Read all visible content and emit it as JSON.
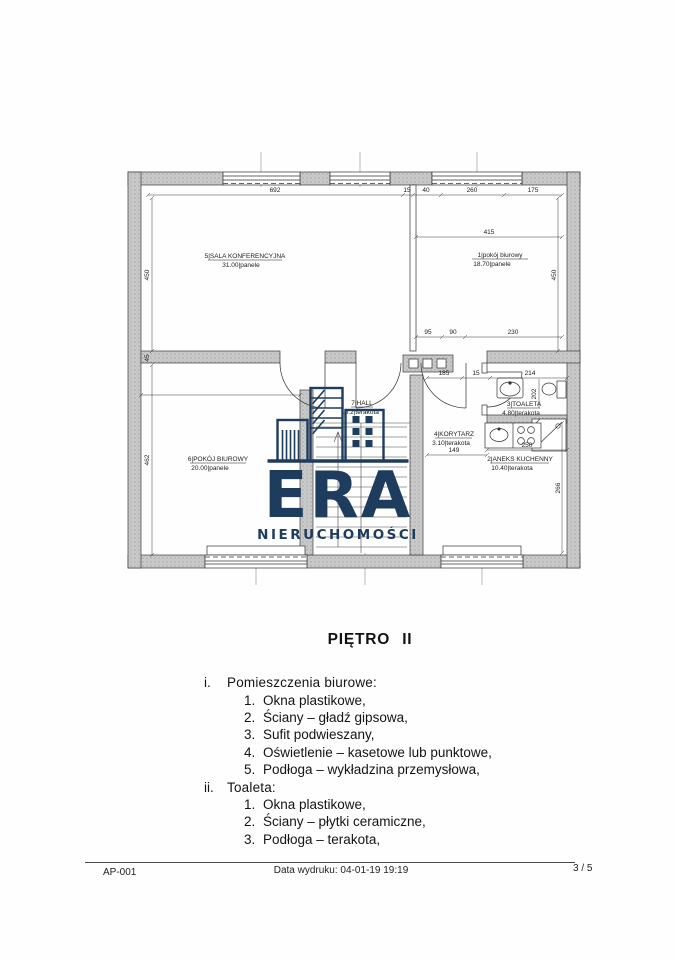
{
  "page": {
    "heading": "PIĘTRO II",
    "footer": {
      "doc_id": "AP-001",
      "print_date": "Data wydruku: 04-01-19 19:19",
      "page_number": "3 / 5"
    }
  },
  "logo": {
    "title": "ERA",
    "subtitle": "NIERUCHOMOŚCI",
    "color": "#1e3c5e"
  },
  "floorplan": {
    "rooms": [
      {
        "name": "5|SALA KONFERENCYJNA",
        "area": "31.00|panele"
      },
      {
        "name": "1|pokój biurowy",
        "area": "18.70|panele"
      },
      {
        "name": "6|POKÓJ BIUROWY",
        "area": "20.00|panele"
      },
      {
        "name": "7|HALL",
        "area": "16.2|terakota"
      },
      {
        "name": "4|KORYTARZ",
        "area": "3.10|terakota"
      },
      {
        "name": "3|TOALETA",
        "area": "4.80|terakota"
      },
      {
        "name": "2|ANEKS KUCHENNY",
        "area": "10.40|terakota"
      }
    ],
    "dims": {
      "a692": "692",
      "a15": "15",
      "a40": "40",
      "a260": "260",
      "a175": "175",
      "a415": "415",
      "a450l": "450",
      "a45": "45",
      "a462": "462",
      "a428": "428",
      "a450r": "450",
      "a95": "95",
      "a90": "90",
      "a230": "230",
      "b185": "185",
      "b15": "15",
      "b214": "214",
      "a202": "202",
      "a149": "149",
      "a250": "250",
      "a266": "266"
    }
  },
  "specs": {
    "sections": [
      {
        "marker": "i.",
        "title": "Pomieszczenia biurowe:",
        "items": [
          {
            "n": "1.",
            "text": "Okna plastikowe,"
          },
          {
            "n": "2.",
            "text": "Ściany – gładź gipsowa,"
          },
          {
            "n": "3.",
            "text": "Sufit podwieszany,"
          },
          {
            "n": "4.",
            "text": "Oświetlenie – kasetowe lub punktowe,"
          },
          {
            "n": "5.",
            "text": "Podłoga – wykładzina przemysłowa,"
          }
        ]
      },
      {
        "marker": "ii.",
        "title": "Toaleta:",
        "items": [
          {
            "n": "1.",
            "text": "Okna plastikowe,"
          },
          {
            "n": "2.",
            "text": "Ściany – płytki ceramiczne,"
          },
          {
            "n": "3.",
            "text": "Podłoga – terakota,"
          }
        ]
      }
    ]
  }
}
